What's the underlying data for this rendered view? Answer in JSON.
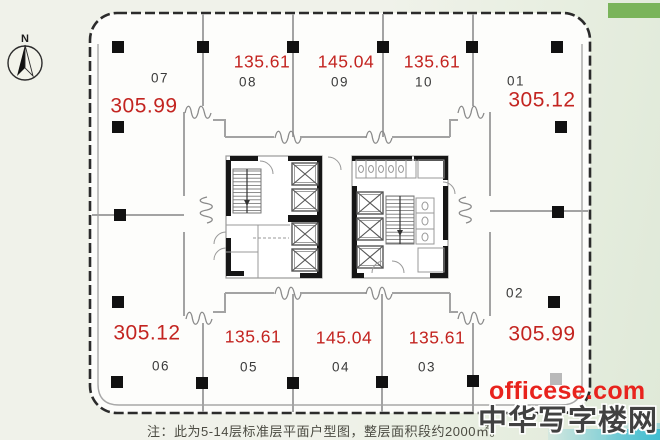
{
  "floor_plan": {
    "compass_north": "N",
    "note": "注：此为5-14层标准层平面户型图，整层面积段约2000㎡。",
    "units": [
      {
        "id": "07",
        "area": "305.99"
      },
      {
        "id": "08",
        "area": "135.61"
      },
      {
        "id": "09",
        "area": "145.04"
      },
      {
        "id": "10",
        "area": "135.61"
      },
      {
        "id": "01",
        "area": "305.12"
      },
      {
        "id": "06",
        "area": "305.12"
      },
      {
        "id": "05",
        "area": "135.61"
      },
      {
        "id": "04",
        "area": "145.04"
      },
      {
        "id": "03",
        "area": "135.61"
      },
      {
        "id": "02",
        "area": "305.99"
      }
    ]
  },
  "watermark": {
    "site": "officese.com",
    "name": "中华写字楼网"
  },
  "colors": {
    "area_text": "#c32420",
    "unit_text": "#3a3a3a",
    "watermark_red": "#e8231d",
    "green_bar": "#7ab45a",
    "teal_strip": "#41bdd0"
  }
}
